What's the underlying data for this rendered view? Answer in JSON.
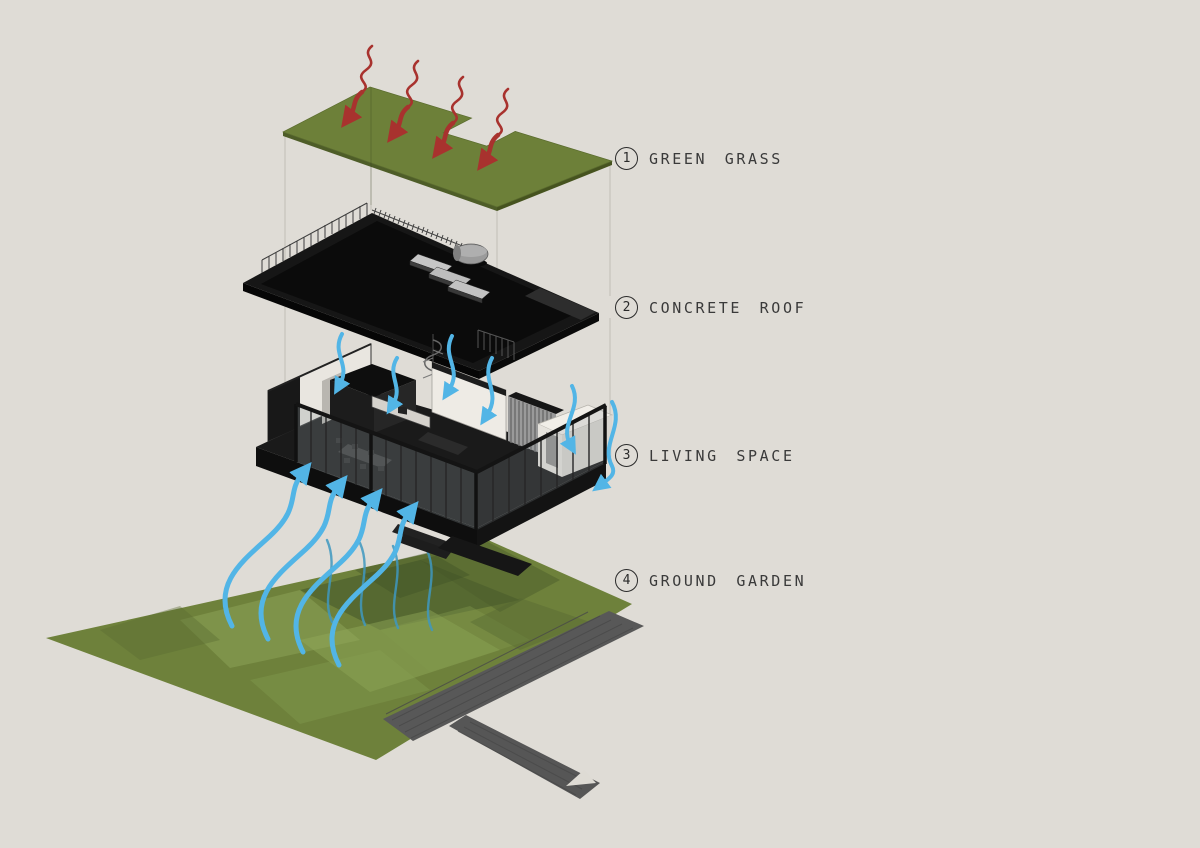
{
  "legend": {
    "items": [
      {
        "number": "1",
        "label": "GREEN GRASS"
      },
      {
        "number": "2",
        "label": "CONCRETE ROOF"
      },
      {
        "number": "3",
        "label": "LIVING SPACE"
      },
      {
        "number": "4",
        "label": "GROUND GARDEN"
      }
    ]
  },
  "colors": {
    "background": "#dfdcd6",
    "grass_green": "#6d8039",
    "grass_edge": "#4e5d28",
    "roof_black": "#161616",
    "slab_black": "#1a1a1a",
    "wall_white": "#e9e6e0",
    "garden_green": "#6e813b",
    "path_gray": "#585858",
    "heat_red": "#a8322e",
    "airflow_blue": "#52b5e6",
    "airflow_teal": "#3f98c0",
    "label_ink": "#2a2a2a"
  },
  "icons": {
    "heat_arrow": "red wavy arrow pointing down",
    "airflow_arrow": "blue s-curve arrow pointing up",
    "entrance_marker": "white triangle on walkway",
    "number_circle": "thin circled digit"
  }
}
